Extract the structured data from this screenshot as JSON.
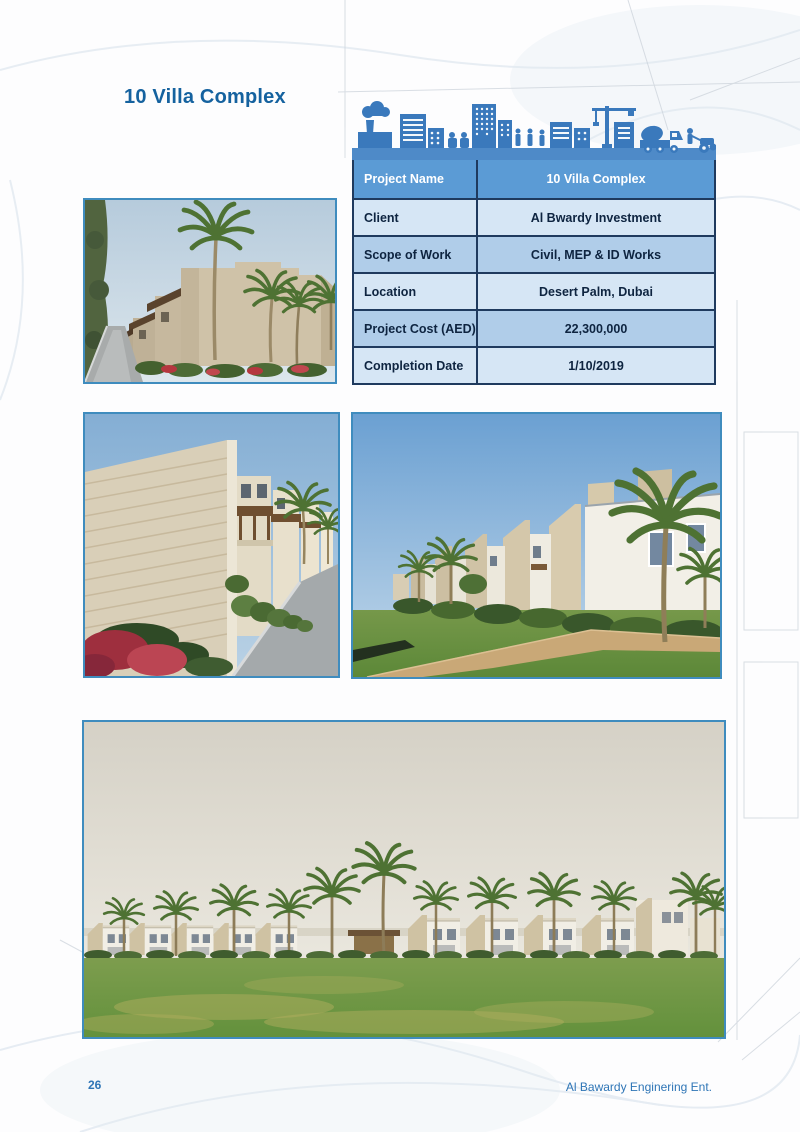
{
  "page": {
    "title": "10 Villa Complex",
    "page_number": "26",
    "footer_company": "Al Bawardy Enginering Ent."
  },
  "project_table": {
    "header": {
      "label": "Project Name",
      "value": "10 Villa Complex"
    },
    "rows": [
      {
        "label": "Client",
        "value": "Al Bwardy Investment"
      },
      {
        "label": "Scope of Work",
        "value": "Civil, MEP & ID Works"
      },
      {
        "label": "Location",
        "value": "Desert Palm, Dubai"
      },
      {
        "label": "Project Cost (AED)",
        "value": "22,300,000"
      },
      {
        "label": "Completion Date",
        "value": "1/10/2019"
      }
    ]
  },
  "icons": {
    "construction_skyline": "construction-skyline-icon"
  },
  "colors": {
    "accent_blue": "#5b9bd5",
    "skyline_blue": "#3a79bc",
    "title_blue": "#15629f",
    "footer_blue": "#2e75b6",
    "row_light": "#d6e6f5",
    "row_medium": "#b0cde9",
    "table_border": "#1f3a5e",
    "photo_border": "#3f8cbe"
  },
  "photos": [
    {
      "name": "villa-exterior-with-palms-photo"
    },
    {
      "name": "villa-street-view-photo"
    },
    {
      "name": "villa-row-garden-photo"
    },
    {
      "name": "villa-complex-panorama-photo"
    }
  ]
}
